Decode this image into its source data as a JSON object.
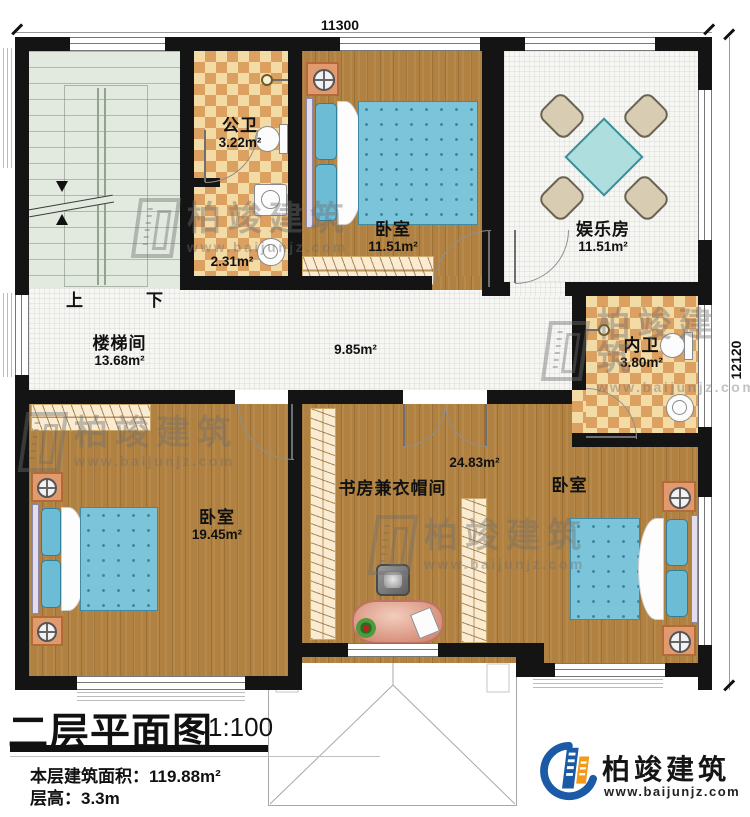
{
  "plan": {
    "dim_top": "11300",
    "dim_right": "12120",
    "rooms": {
      "public_bath": {
        "name": "公卫",
        "area": "3.22m²"
      },
      "bath_lobby": {
        "area": "2.31m²"
      },
      "bedroom_top": {
        "name": "卧室",
        "area": "11.51m²"
      },
      "entertainment": {
        "name": "娱乐房",
        "area": "11.51m²"
      },
      "stairwell": {
        "name": "楼梯间",
        "area": "13.68m²"
      },
      "hallway": {
        "area": "9.85m²"
      },
      "inner_bath": {
        "name": "内卫",
        "area": "3.80m²"
      },
      "bedroom_left": {
        "name": "卧室",
        "area": "19.45m²"
      },
      "study": {
        "name": "书房兼衣帽间",
        "area": "24.83m²"
      },
      "bedroom_right": {
        "name": "卧室"
      }
    },
    "stairs": {
      "up": "上",
      "down": "下"
    }
  },
  "titleblock": {
    "title": "二层平面图",
    "scale": "1:100",
    "area_label": "本层建筑面积：",
    "area_value": "119.88m²",
    "height_label": "层高：",
    "height_value": "3.3m"
  },
  "watermark": {
    "brand": "柏竣建筑",
    "url": "www.baijunjz.com"
  },
  "logo": {
    "brand": "柏竣建筑",
    "url": "www.baijunjz.com"
  },
  "colors": {
    "wall": "#141414",
    "wood": "#b08140",
    "checker": "#dca061",
    "stair": "#e2e9df",
    "bed": "#7cc4da",
    "brand_blue": "#1a5aa6",
    "brand_orange": "#f49a18"
  }
}
